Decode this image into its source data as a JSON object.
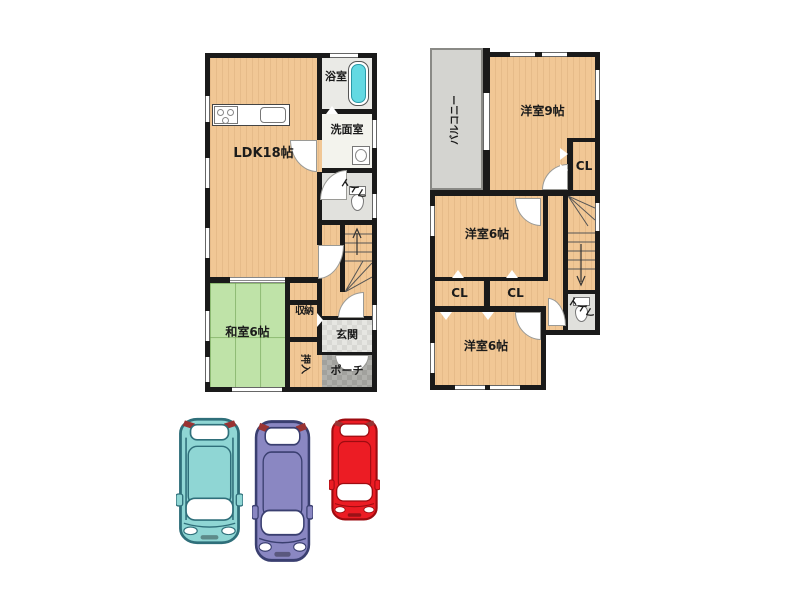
{
  "floor1": {
    "labels": {
      "ldk": "LDK18帖",
      "bath": "浴室",
      "washroom": "洗面室",
      "toilet": "トイレ",
      "tatami_room": "和室6帖",
      "storage": "収納",
      "futon_closet": "押入",
      "entrance": "玄関",
      "porch": "ポーチ"
    }
  },
  "floor2": {
    "labels": {
      "balcony": "バルコニー",
      "bedroom9": "洋室9帖",
      "closet_right": "CL",
      "bedroom6_middle": "洋室6帖",
      "closet_left": "CL",
      "closet_center": "CL",
      "bedroom6_bottom": "洋室6帖",
      "toilet": "トイレ"
    }
  },
  "colors": {
    "wall": "#1a1a1a",
    "wood_floor": "#F1C795",
    "tatami": "#BFE3A8",
    "balcony_floor": "#D4D4D0",
    "bath_floor": "#EAEAE6",
    "washroom_floor": "#F3F3ED",
    "toilet_floor": "#E1E1DD",
    "bathtub": "#63D9E2",
    "taillight": "#993333"
  },
  "cars": [
    {
      "name": "teal-car",
      "body": "#8FD6D4",
      "outline": "#2F6F7A"
    },
    {
      "name": "purple-car",
      "body": "#8A87C2",
      "outline": "#3A3F70"
    },
    {
      "name": "red-car",
      "body": "#EC1C24",
      "outline": "#9E0B10"
    }
  ]
}
